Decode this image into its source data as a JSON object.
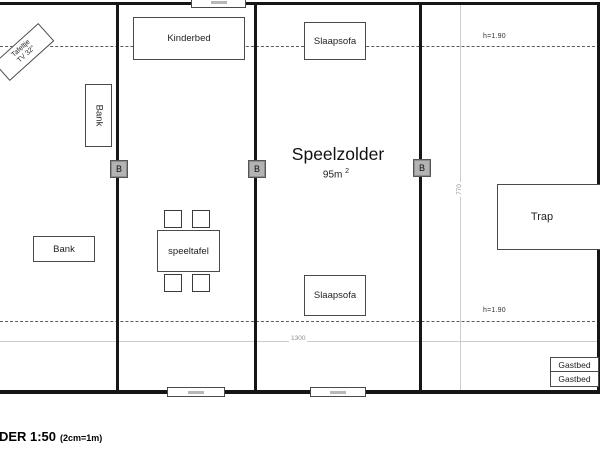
{
  "plan": {
    "title": "Speelzolder",
    "area_value": "95m",
    "area_exp": "2"
  },
  "furniture": {
    "kinderbed": "Kinderbed",
    "slaapsofa_top": "Slaapsofa",
    "slaapsofa_bottom": "Slaapsofa",
    "bank_vertical": "Bank",
    "bank_horizontal": "Bank",
    "speeltafel": "speeltafel",
    "trap": "Trap",
    "gastbed_1": "Gastbed",
    "gastbed_2": "Gastbed",
    "tafeltje_line1": "Tafeltje",
    "tafeltje_line2": "TV 32\""
  },
  "dimensions": {
    "width_label": "1300",
    "depth_label": "770",
    "height_note_top": "h=1.90",
    "height_note_bottom": "h=1.90"
  },
  "markers": {
    "b": "B"
  },
  "scale_note": {
    "main": "LDER 1:50",
    "detail": "(2cm=1m)"
  },
  "colors": {
    "wall": "#161616",
    "marker_fill": "#b3b3b3",
    "dimension_line": "#cccccc",
    "dash_line": "#5a5a5a"
  }
}
